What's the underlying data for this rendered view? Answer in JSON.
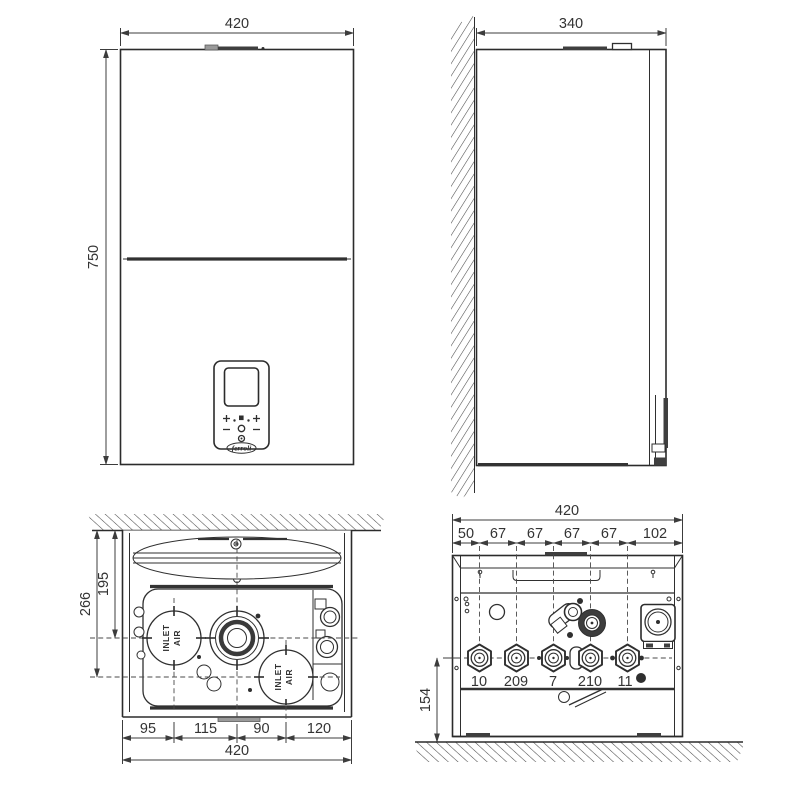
{
  "colors": {
    "line": "#2f2f2f",
    "dimension": "#3c3c3c",
    "dark_fill": "#3f3f3f",
    "gray_fill": "#9a9a9a",
    "background": "#ffffff"
  },
  "views": {
    "front": {
      "width_dim": "420",
      "height_dim": "750",
      "brand_logo": "ferroli"
    },
    "side": {
      "depth_dim": "340"
    },
    "top": {
      "total_width_dim": "420",
      "segment_dims": [
        "95",
        "115",
        "90",
        "120"
      ],
      "wall_to_flue_dim": "195",
      "wall_to_front_inlet_dim": "266",
      "inlet_word1": "INLET",
      "inlet_word2": "AIR"
    },
    "bottom": {
      "total_width_dim": "420",
      "segment_dims": [
        "50",
        "67",
        "67",
        "67",
        "67",
        "102"
      ],
      "wall_to_connections_dim": "154",
      "connection_labels": [
        "10",
        "209",
        "7",
        "210",
        "11"
      ]
    }
  }
}
